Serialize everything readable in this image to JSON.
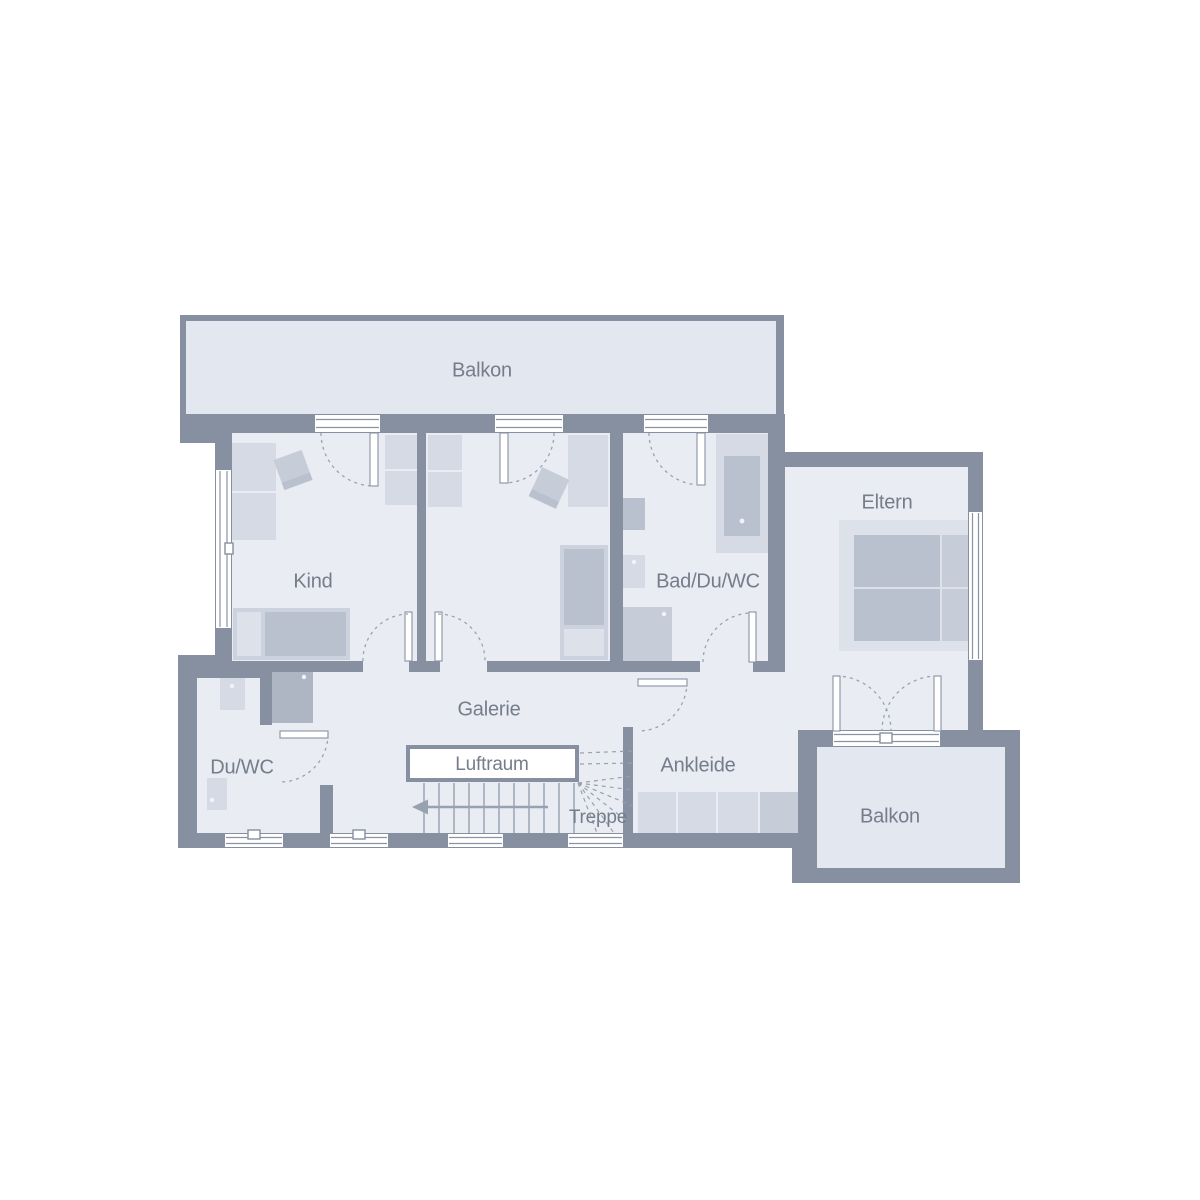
{
  "palette": {
    "paper": "#ffffff",
    "wall": "#8790a0",
    "floor": "#e9ecf2",
    "balcony_floor": "#e3e7ef",
    "furn_light": "#d5dae4",
    "furn_med": "#c6cdd9",
    "furn_dark": "#b9c1cf",
    "furn_tall": "#aeb6c4",
    "furn_base": "#cdd3de",
    "furn_pillow": "#dde1e9",
    "win_line": "#8a93a3",
    "dash": "#9aa2b1",
    "tread": "#98a1b0",
    "text": "#757d8b"
  },
  "rooms": {
    "balkon_top": "Balkon",
    "kind": "Kind",
    "bad_du_wc": "Bad/Du/WC",
    "eltern": "Eltern",
    "du_wc": "Du/WC",
    "galerie": "Galerie",
    "luftraum": "Luftraum",
    "treppe": "Treppe",
    "ankleide": "Ankleide",
    "balkon_bottom": "Balkon"
  }
}
